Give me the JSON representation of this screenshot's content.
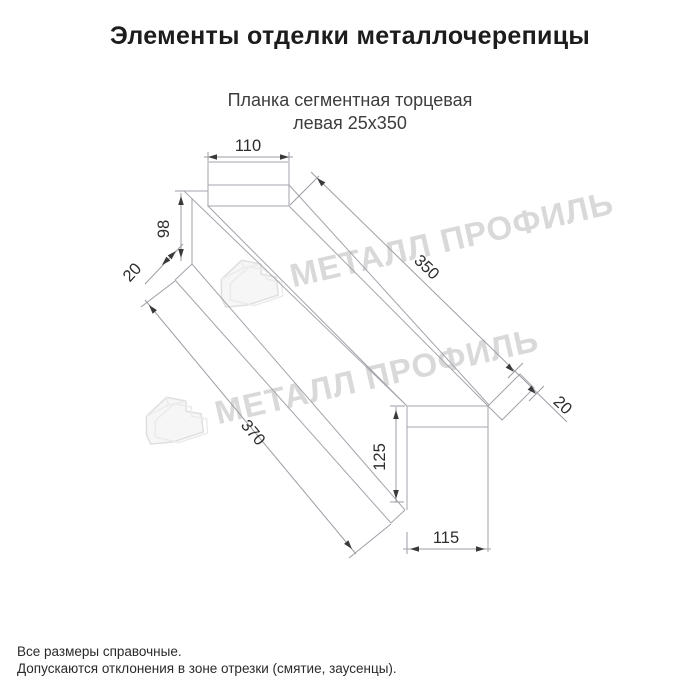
{
  "title": "Элементы отделки металлочерепицы",
  "subtitle": {
    "line1": "Планка сегментная торцевая",
    "line2": "левая 25х350"
  },
  "diagram": {
    "type": "technical-drawing",
    "dims": {
      "top_width": "110",
      "left_height": "98",
      "left_lip": "20",
      "length_top": "350",
      "length_bottom": "370",
      "right_lip": "20",
      "end_height": "125",
      "end_width": "115"
    },
    "watermark": {
      "text": "МЕТАЛЛ ПРОФИЛЬ",
      "logo": "house-logo",
      "color": "#d9d9d9"
    },
    "colors": {
      "line": "#a4a4ac",
      "dim_text": "#2d2d2d"
    }
  },
  "footer": {
    "line1": "Все размеры справочные.",
    "line2": "Допускаются отклонения в зоне отрезки (смятие, заусенцы)."
  }
}
